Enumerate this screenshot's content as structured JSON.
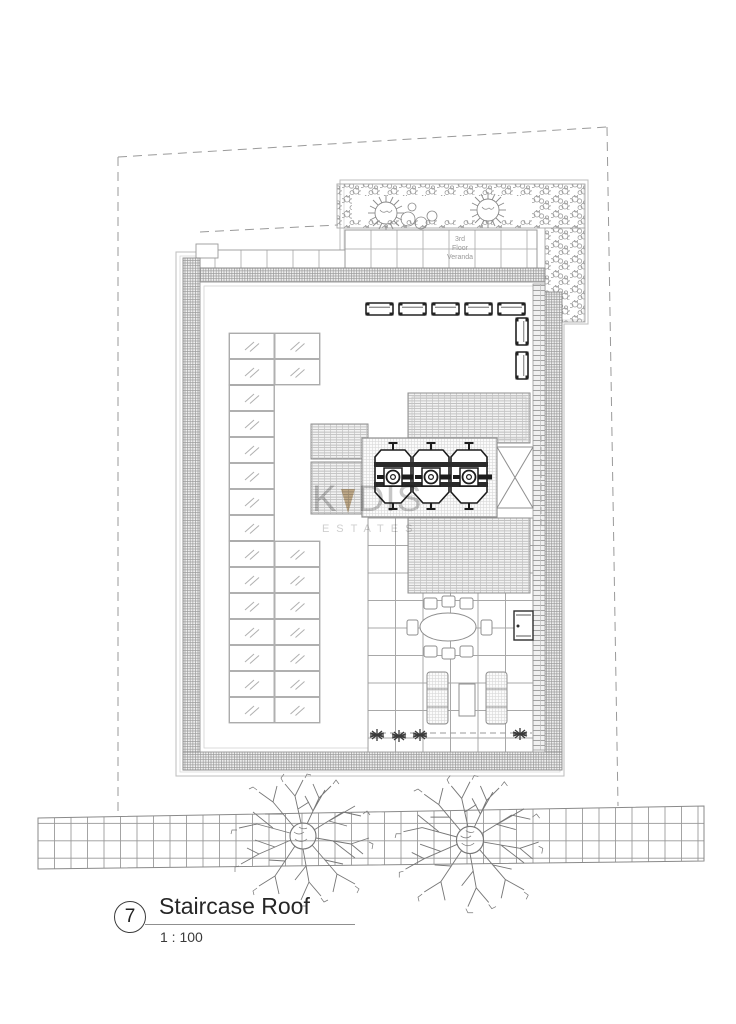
{
  "plan": {
    "veranda_label": "3rd\nFloor\nVeranda"
  },
  "watermark": {
    "prefix": "K",
    "suffix": "DIS",
    "subtitle": "ESTATES",
    "letter_color": "#c6c6c6",
    "triangle_color": "#c9b28f"
  },
  "title_block": {
    "number": "7",
    "title": "Staircase Roof",
    "scale": "1 : 100"
  },
  "colors": {
    "paper": "#ffffff",
    "line_light": "#b3b3b3",
    "line_mid": "#8f8f8f",
    "line_dark": "#222222",
    "hatch": "#a8a8a8"
  },
  "equipment": {
    "water_tanks_count": 3,
    "ac_units_top_count": 5,
    "ac_units_right_count": 2,
    "trees_count": 2
  }
}
